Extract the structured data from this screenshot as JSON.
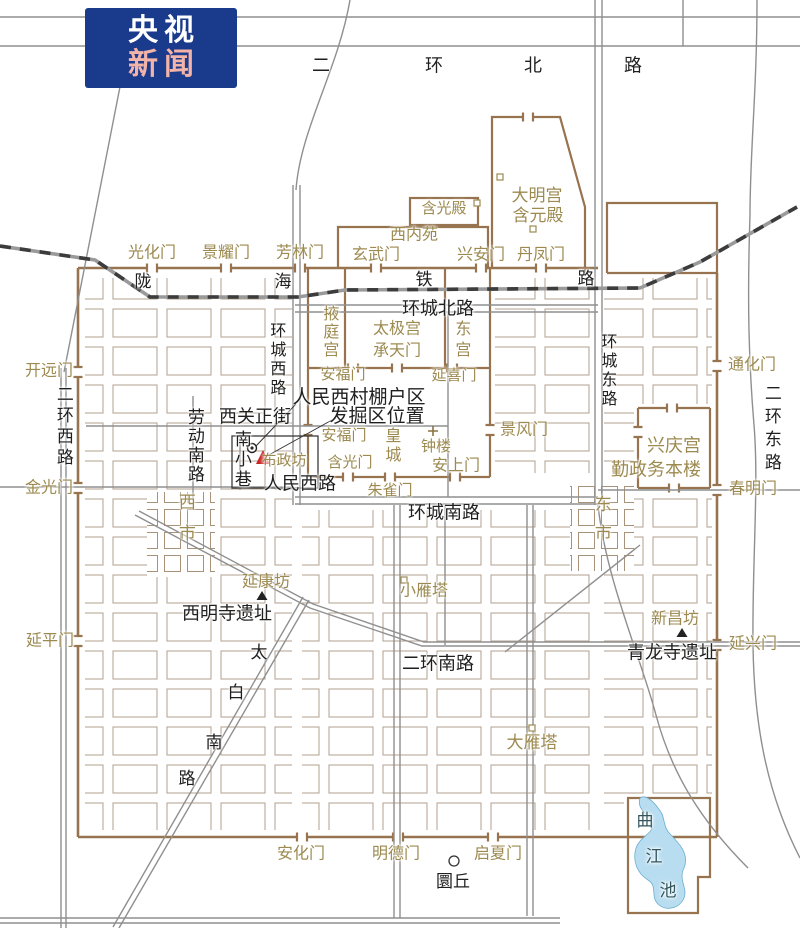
{
  "logo": {
    "line1": "央视",
    "line2": "新闻",
    "bg": "#1a3a8c",
    "line1_color": "#ffffff",
    "line2_color": "#f2b3a8"
  },
  "map": {
    "colors": {
      "site_gold": "#9c8a50",
      "road_black": "#1f1f1f",
      "wall_brown": "#97744f",
      "water_text": "#33565e",
      "lake_fill": "#b9ddf0",
      "marker_red": "#cc2222"
    },
    "labels": [
      {
        "t": "光化门",
        "x": 152,
        "y": 254,
        "c": "s"
      },
      {
        "t": "景耀门",
        "x": 226,
        "y": 254,
        "c": "s"
      },
      {
        "t": "芳林门",
        "x": 300,
        "y": 254,
        "c": "s"
      },
      {
        "t": "玄武门",
        "x": 376,
        "y": 256,
        "c": "s"
      },
      {
        "t": "兴安门",
        "x": 481,
        "y": 256,
        "c": "s"
      },
      {
        "t": "丹凤门",
        "x": 541,
        "y": 256,
        "c": "s"
      },
      {
        "t": "西内苑",
        "x": 414,
        "y": 236,
        "c": "s"
      },
      {
        "t": "含光殿",
        "x": 444,
        "y": 210,
        "c": "s",
        "fs": 15
      },
      {
        "t": "大明宫",
        "x": 537,
        "y": 196,
        "c": "s",
        "fs": 17
      },
      {
        "t": "含元殿",
        "x": 538,
        "y": 216,
        "c": "s",
        "fs": 17
      },
      {
        "t": "开远门",
        "x": 49,
        "y": 372,
        "c": "s"
      },
      {
        "t": "金光门",
        "x": 49,
        "y": 489,
        "c": "s"
      },
      {
        "t": "延平门",
        "x": 50,
        "y": 642,
        "c": "s"
      },
      {
        "t": "通化门",
        "x": 752,
        "y": 366,
        "c": "s"
      },
      {
        "t": "春明门",
        "x": 753,
        "y": 490,
        "c": "s"
      },
      {
        "t": "延兴门",
        "x": 753,
        "y": 645,
        "c": "s"
      },
      {
        "t": "安化门",
        "x": 301,
        "y": 855,
        "c": "s"
      },
      {
        "t": "明德门",
        "x": 396,
        "y": 855,
        "c": "s"
      },
      {
        "t": "启夏门",
        "x": 498,
        "y": 855,
        "c": "s"
      },
      {
        "t": "安福门",
        "x": 343,
        "y": 376,
        "c": "s",
        "fs": 15
      },
      {
        "t": "延喜门",
        "x": 454,
        "y": 377,
        "c": "s",
        "fs": 15
      },
      {
        "t": "安福门",
        "x": 344,
        "y": 437,
        "c": "s",
        "fs": 15
      },
      {
        "t": "景风门",
        "x": 524,
        "y": 431,
        "c": "s"
      },
      {
        "t": "含光门",
        "x": 350,
        "y": 464,
        "c": "s",
        "fs": 15
      },
      {
        "t": "朱雀门",
        "x": 390,
        "y": 492,
        "c": "s",
        "fs": 15
      },
      {
        "t": "安上门",
        "x": 456,
        "y": 467,
        "c": "s"
      },
      {
        "t": "钟楼",
        "x": 436,
        "y": 448,
        "c": "s",
        "fs": 15
      },
      {
        "t": "兴庆宫",
        "x": 674,
        "y": 446,
        "c": "s",
        "fs": 18
      },
      {
        "t": "勤政务本楼",
        "x": 656,
        "y": 470,
        "c": "s",
        "fs": 18
      },
      {
        "t": "延康坊",
        "x": 266,
        "y": 583,
        "c": "s"
      },
      {
        "t": "小雁塔",
        "x": 424,
        "y": 592,
        "c": "s"
      },
      {
        "t": "新昌坊",
        "x": 675,
        "y": 620,
        "c": "s"
      },
      {
        "t": "大雁塔",
        "x": 532,
        "y": 743,
        "c": "s",
        "fs": 17
      },
      {
        "t": "布政坊",
        "x": 284,
        "y": 462,
        "c": "s",
        "fs": 15
      },
      {
        "t": "太极宫",
        "x": 397,
        "y": 330,
        "c": "s"
      },
      {
        "t": "承天门",
        "x": 397,
        "y": 352,
        "c": "s"
      },
      {
        "t": "掖庭宫",
        "x": 328,
        "y": 332,
        "c": "s",
        "v": 1,
        "fs": 16,
        "ls": 2
      },
      {
        "t": "东宫",
        "x": 460,
        "y": 341,
        "c": "s",
        "v": 1,
        "fs": 16,
        "ls": 5
      },
      {
        "t": "皇城",
        "x": 390,
        "y": 446,
        "c": "s",
        "v": 1,
        "fs": 16,
        "ls": 3
      },
      {
        "t": "西市",
        "x": 185,
        "y": 524,
        "c": "s",
        "v": 1,
        "fs": 17,
        "ls": 14
      },
      {
        "t": "东市",
        "x": 601,
        "y": 524,
        "c": "s",
        "v": 1,
        "fs": 17,
        "ls": 12
      },
      {
        "t": "二",
        "x": 321,
        "y": 66,
        "c": "r",
        "fs": 18
      },
      {
        "t": "环",
        "x": 434,
        "y": 66,
        "c": "r",
        "fs": 18
      },
      {
        "t": "北",
        "x": 533,
        "y": 66,
        "c": "r",
        "fs": 18
      },
      {
        "t": "路",
        "x": 633,
        "y": 66,
        "c": "r",
        "fs": 18
      },
      {
        "t": "陇",
        "x": 143,
        "y": 282,
        "c": "r"
      },
      {
        "t": "海",
        "x": 283,
        "y": 282,
        "c": "r"
      },
      {
        "t": "铁",
        "x": 424,
        "y": 280,
        "c": "r"
      },
      {
        "t": "路",
        "x": 586,
        "y": 279,
        "c": "r"
      },
      {
        "t": "环城北路",
        "x": 438,
        "y": 309,
        "c": "r",
        "fs": 18
      },
      {
        "t": "环城西路",
        "x": 275,
        "y": 360,
        "c": "r",
        "v": 1,
        "fs": 16,
        "ls": 3
      },
      {
        "t": "环城东路",
        "x": 606,
        "y": 371,
        "c": "r",
        "v": 1,
        "fs": 16,
        "ls": 3
      },
      {
        "t": "二环西路",
        "x": 63,
        "y": 427,
        "c": "r",
        "v": 1,
        "fs": 17,
        "ls": 4
      },
      {
        "t": "二环东路",
        "x": 771,
        "y": 430,
        "c": "r",
        "v": 1,
        "fs": 17,
        "ls": 6
      },
      {
        "t": "劳动南路",
        "x": 194,
        "y": 446,
        "c": "r",
        "v": 1,
        "fs": 17,
        "ls": 2
      },
      {
        "t": "西关正街",
        "x": 255,
        "y": 417,
        "c": "r",
        "fs": 18
      },
      {
        "t": "南小巷",
        "x": 241,
        "y": 460,
        "c": "r",
        "v": 1,
        "fs": 17,
        "ls": 3
      },
      {
        "t": "人民西路",
        "x": 300,
        "y": 484,
        "c": "r",
        "fs": 18
      },
      {
        "t": "环城南路",
        "x": 444,
        "y": 513,
        "c": "r",
        "fs": 18
      },
      {
        "t": "二环南路",
        "x": 438,
        "y": 664,
        "c": "r",
        "fs": 18
      },
      {
        "t": "西明寺遗址",
        "x": 227,
        "y": 614,
        "c": "r",
        "fs": 18
      },
      {
        "t": "青龙寺遗址",
        "x": 672,
        "y": 653,
        "c": "r",
        "fs": 18
      },
      {
        "t": "太",
        "x": 259,
        "y": 653,
        "c": "r"
      },
      {
        "t": "白",
        "x": 236,
        "y": 693,
        "c": "r"
      },
      {
        "t": "南",
        "x": 214,
        "y": 743,
        "c": "r"
      },
      {
        "t": "路",
        "x": 187,
        "y": 779,
        "c": "r"
      },
      {
        "t": "圜丘",
        "x": 453,
        "y": 882,
        "c": "r"
      },
      {
        "t": "人民西村棚户区",
        "x": 359,
        "y": 398,
        "c": "r",
        "fs": 19
      },
      {
        "t": "发掘区位置",
        "x": 377,
        "y": 417,
        "c": "r",
        "fs": 19
      },
      {
        "t": "曲",
        "x": 645,
        "y": 821,
        "c": "w"
      },
      {
        "t": "江",
        "x": 654,
        "y": 857,
        "c": "w"
      },
      {
        "t": "池",
        "x": 668,
        "y": 891,
        "c": "w"
      }
    ]
  }
}
